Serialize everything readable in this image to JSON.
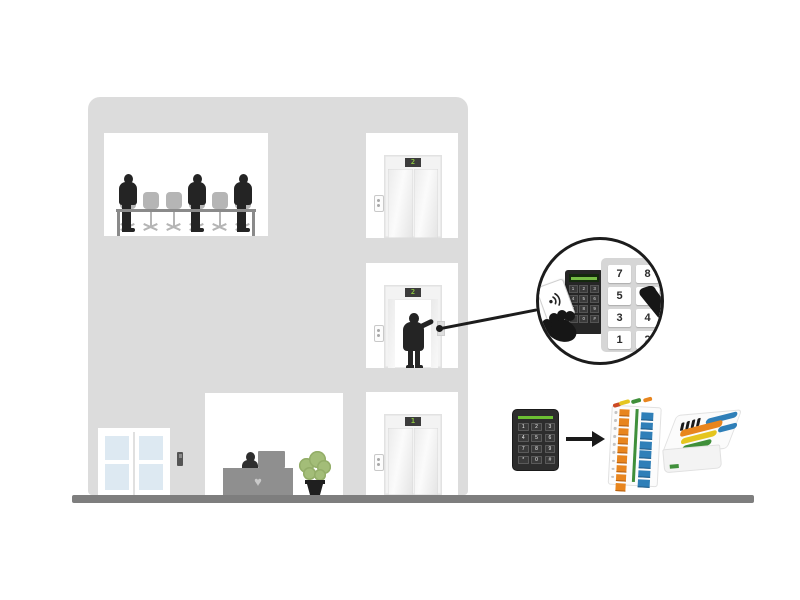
{
  "scene": {
    "description": "Office building cross-section showing elevator access control: a passenger presents a card to a reader keypad in the elevator and presses a floor button; the keypad reader connects via an I/O relay module to a door controller."
  },
  "building": {
    "floors": {
      "top_elevator_display": "2",
      "middle_elevator_display": "2",
      "bottom_elevator_display": "1"
    }
  },
  "callout": {
    "floor_panel_buttons": [
      "7",
      "8",
      "5",
      "6",
      "3",
      "4",
      "1",
      "2"
    ]
  },
  "keypad_keys": [
    "1",
    "2",
    "3",
    "4",
    "5",
    "6",
    "7",
    "8",
    "9",
    "*",
    "0",
    "#"
  ],
  "icons": {
    "desk_logo": "♥"
  },
  "colors": {
    "building": "#dcdcdc",
    "ground": "#7e7e7e",
    "silhouette": "#242424",
    "chair_gray": "#b5b5b5",
    "door_glass": "#dde9f2",
    "display_background": "#3c3c3c",
    "display_digit_green": "#8bc83e",
    "keypad_body": "#2d2d2d",
    "keypad_accent_green": "#6cc033",
    "panel_gray": "#d6d6d6",
    "terminal_orange": "#e8851e",
    "terminal_blue": "#2f7fb8",
    "wire_yellow": "#e5c51f",
    "wire_green": "#3f8f3a",
    "plant_green": "#a3bd78",
    "desk_gray": "#8f8f8f"
  }
}
